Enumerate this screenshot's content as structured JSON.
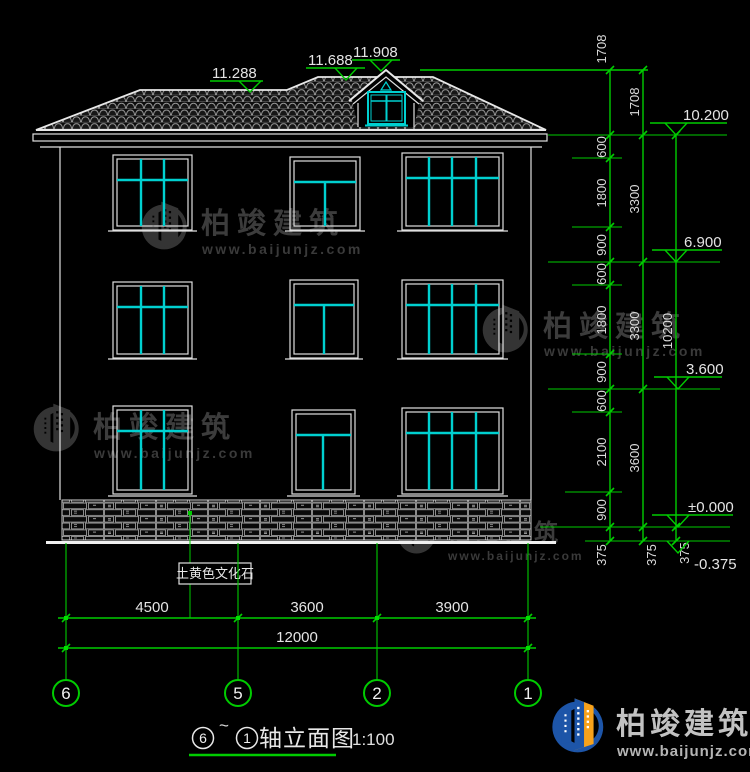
{
  "drawing": {
    "roof_marks": {
      "ridge_main": "11.288",
      "ridge_upper": "11.688",
      "ridge_dormer": "11.908"
    },
    "level_marks": {
      "eave": "10.200",
      "level3": "6.900",
      "level2": "3.600",
      "ground": "±0.000",
      "site": "-0.375"
    },
    "stone_label": "土黄色文化石"
  },
  "dims": {
    "right_inner": [
      "1708",
      "600",
      "1800",
      "900",
      "600",
      "1800",
      "900",
      "600",
      "2100",
      "900",
      "375"
    ],
    "right_outer": [
      "1708",
      "3300",
      "3300",
      "3600",
      "375"
    ],
    "right_total": "10200",
    "right_total_below": "375",
    "bottom_segments": [
      "4500",
      "3600",
      "3900"
    ],
    "bottom_total": "12000"
  },
  "axes": [
    "6",
    "5",
    "2",
    "1"
  ],
  "title": {
    "axis_from": "6",
    "tilde": "~",
    "axis_to": "1",
    "name": "轴立面图",
    "scale": "1:100"
  },
  "watermark": {
    "name": "柏竣建筑",
    "url": "www.baijunjz.com"
  },
  "logo": {
    "name": "柏竣建筑",
    "url": "www.baijunjz.com"
  },
  "colors": {
    "green": "#00cc00",
    "white": "#e0e0e0",
    "cyan": "#00d0d0",
    "background": "#000000",
    "watermark": "#3c3c3c",
    "logo_blue": "#1d55a8",
    "logo_orange": "#f7a21b"
  }
}
